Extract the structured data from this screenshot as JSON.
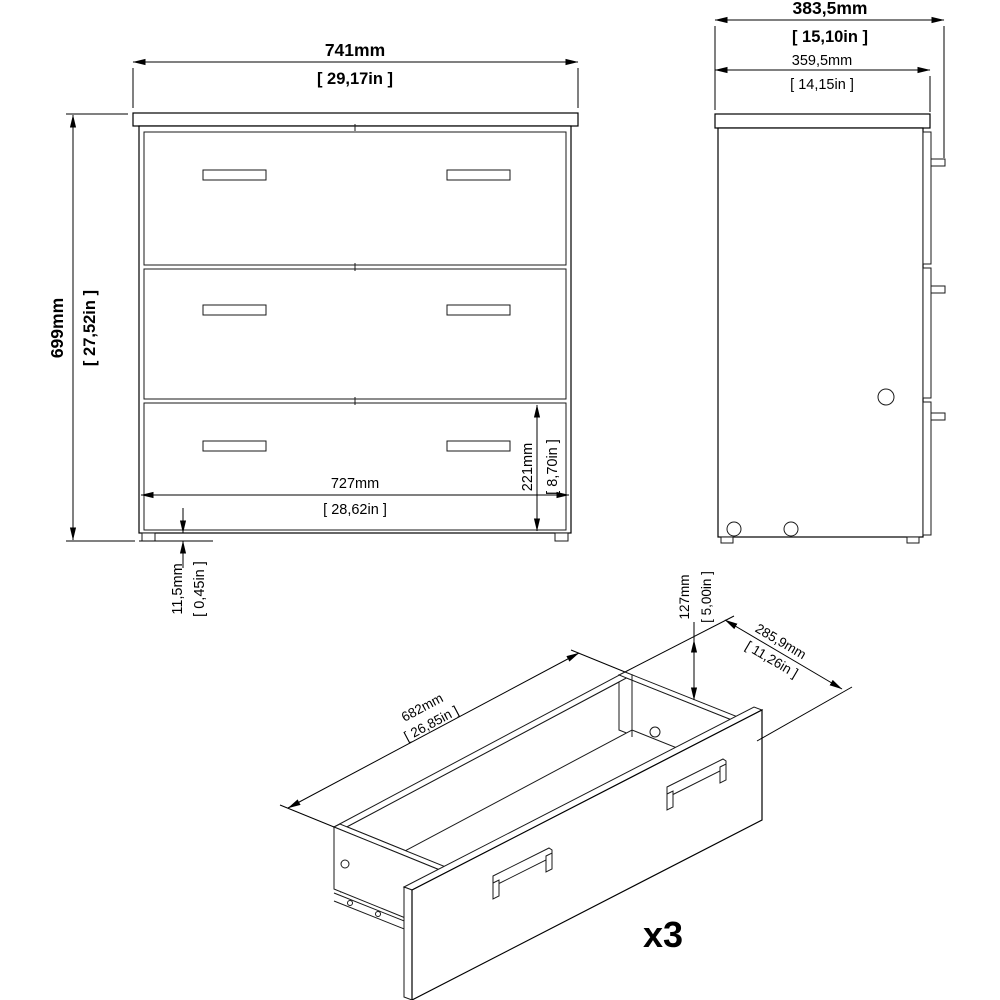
{
  "drawing": {
    "background": "#ffffff",
    "line_color": "#000000",
    "views": {
      "front": {
        "label": "front-orthographic-view"
      },
      "side": {
        "label": "side-orthographic-view"
      },
      "drawer": {
        "label": "drawer-isometric-view",
        "quantity": "x3"
      }
    },
    "dimensions": {
      "front_width": {
        "mm": "741mm",
        "inch": "[ 29,17in ]"
      },
      "front_height": {
        "mm": "699mm",
        "inch": "[ 27,52in ]"
      },
      "drawer_front_width": {
        "mm": "727mm",
        "inch": "[ 28,62in ]"
      },
      "bottom_drawer_height": {
        "mm": "221mm",
        "inch": "[ 8,70in ]"
      },
      "plinth_height": {
        "mm": "11,5mm",
        "inch": "[ 0,45in ]"
      },
      "total_depth": {
        "mm": "383,5mm",
        "inch": "[ 15,10in ]"
      },
      "body_depth": {
        "mm": "359,5mm",
        "inch": "[ 14,15in ]"
      },
      "drawer_inner_width": {
        "mm": "682mm",
        "inch": "[ 26,85in ]"
      },
      "drawer_side_height": {
        "mm": "127mm",
        "inch": "[ 5,00in ]"
      },
      "drawer_depth": {
        "mm": "285,9mm",
        "inch": "[ 11,26in ]"
      }
    }
  }
}
